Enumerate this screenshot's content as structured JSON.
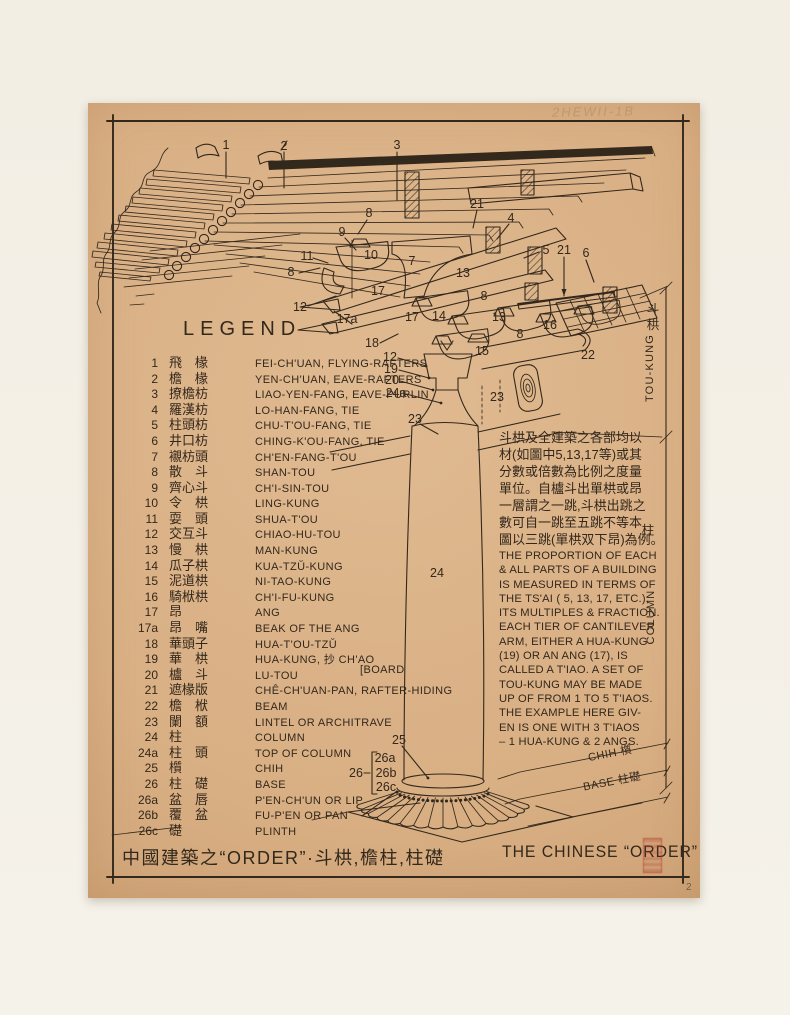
{
  "artwork": {
    "pencil_note": "2HEWII-1B",
    "page_mark": "2"
  },
  "legend": {
    "title": "LEGEND",
    "items": [
      {
        "num": "1",
        "cn": "飛　椽",
        "en": "FEI-CH'UAN, FLYING-RAFTERS"
      },
      {
        "num": "2",
        "cn": "檐　椽",
        "en": "YEN-CH'UAN, EAVE-RAFTERS"
      },
      {
        "num": "3",
        "cn": "撩檐枋",
        "en": "LIAO-YEN-FANG, EAVE-PURLIN"
      },
      {
        "num": "4",
        "cn": "羅漢枋",
        "en": "LO-HAN-FANG, TIE"
      },
      {
        "num": "5",
        "cn": "柱頭枋",
        "en": "CHU-T'OU-FANG, TIE"
      },
      {
        "num": "6",
        "cn": "井口枋",
        "en": "CHING-K'OU-FANG, TIE"
      },
      {
        "num": "7",
        "cn": "襯枋頭",
        "en": "CH'EN-FANG-T'OU"
      },
      {
        "num": "8",
        "cn": "散　斗",
        "en": "SHAN-TOU"
      },
      {
        "num": "9",
        "cn": "齊心斗",
        "en": "CH'I-SIN-TOU"
      },
      {
        "num": "10",
        "cn": "令　栱",
        "en": "LING-KUNG"
      },
      {
        "num": "11",
        "cn": "耍　頭",
        "en": "SHUA-T'OU"
      },
      {
        "num": "12",
        "cn": "交互斗",
        "en": "CHIAO-HU-TOU"
      },
      {
        "num": "13",
        "cn": "慢　栱",
        "en": "MAN-KUNG"
      },
      {
        "num": "14",
        "cn": "瓜子栱",
        "en": "KUA-TZŬ-KUNG"
      },
      {
        "num": "15",
        "cn": "泥道栱",
        "en": "NI-TAO-KUNG"
      },
      {
        "num": "16",
        "cn": "騎栿栱",
        "en": "CH'I-FU-KUNG"
      },
      {
        "num": "17",
        "cn": "昂",
        "en": "ANG"
      },
      {
        "num": "17a",
        "cn": "昂　嘴",
        "en": "BEAK OF THE ANG"
      },
      {
        "num": "18",
        "cn": "華頭子",
        "en": "HUA-T'OU-TZŬ"
      },
      {
        "num": "19",
        "cn": "華　栱",
        "en": "HUA-KUNG, 抄 CH'AO"
      },
      {
        "num": "20",
        "cn": "櫨　斗",
        "en": "LU-TOU",
        "note": "[BOARD"
      },
      {
        "num": "21",
        "cn": "遮椽版",
        "en": "CHÊ-CH'UAN-PAN, RAFTER-HIDING"
      },
      {
        "num": "22",
        "cn": "檐　栿",
        "en": "BEAM"
      },
      {
        "num": "23",
        "cn": "闌　額",
        "en": "LINTEL OR ARCHITRAVE"
      },
      {
        "num": "24",
        "cn": "柱",
        "en": "COLUMN"
      },
      {
        "num": "24a",
        "cn": "柱　頭",
        "en": "TOP OF COLUMN"
      },
      {
        "num": "25",
        "cn": "櫍",
        "en": "CHIH"
      },
      {
        "num": "26",
        "cn": "柱　礎",
        "en": "BASE"
      },
      {
        "num": "26a",
        "cn": "盆　唇",
        "en": "P'EN-CH'UN OR LIP"
      },
      {
        "num": "26b",
        "cn": "覆　盆",
        "en": "FU-P'EN OR PAN"
      },
      {
        "num": "26c",
        "cn": "礎",
        "en": "PLINTH"
      }
    ]
  },
  "notes": {
    "chinese_lines": [
      "斗栱及全建築之各部均以",
      "材(如圖中5,13,17等)或其",
      "分數或倍數為比例之度量",
      "單位。自櫨斗出單栱或昂",
      "一層謂之一跳,斗栱出跳之",
      "數可自一跳至五跳不等本",
      "圖以三跳(單栱双下昂)為例。"
    ],
    "english_lines": [
      "THE PROPORTION OF EACH",
      "& ALL PARTS OF A BUILDING",
      "IS MEASURED IN TERMS OF",
      "THE TS'AI ( 5, 13, 17, ETC.),",
      "ITS MULTIPLES & FRACTION.",
      "EACH TIER OF CANTILEVER",
      "ARM, EITHER A HUA-KUNG",
      "(19) OR AN ANG (17), IS",
      "CALLED A T'IAO.  A SET OF",
      "TOU-KUNG MAY BE MADE",
      "UP OF FROM 1 TO 5 T'IAOS.",
      "THE EXAMPLE HERE GIV-",
      "EN IS ONE WITH 3 T'IAOS",
      "– 1 HUA-KUNG & 2 ANGS."
    ]
  },
  "dimension_labels": {
    "toukung_cn": "斗栱",
    "toukung_en": "TOU-KUNG",
    "column_cn": "柱",
    "column_en": "COLUMN",
    "chih": "CHIH 櫍",
    "base": "BASE 柱礎"
  },
  "title_bar": {
    "chinese": "中國建築之“ORDER”·斗栱,檐柱,柱礎",
    "english": "THE CHINESE “ORDER”"
  },
  "diagram": {
    "callouts": [
      [
        "1",
        226,
        145
      ],
      [
        "2",
        284,
        146
      ],
      [
        "3",
        397,
        145
      ],
      [
        "21",
        477,
        204
      ],
      [
        "4",
        511,
        218
      ],
      [
        "8",
        369,
        213
      ],
      [
        "9",
        342,
        232
      ],
      [
        "11",
        307,
        256
      ],
      [
        "10",
        371,
        255
      ],
      [
        "7",
        412,
        261
      ],
      [
        "5",
        546,
        250
      ],
      [
        "21",
        564,
        250
      ],
      [
        "6",
        586,
        253
      ],
      [
        "8",
        291,
        272
      ],
      [
        "12",
        300,
        307
      ],
      [
        "17",
        378,
        291
      ],
      [
        "13",
        463,
        273
      ],
      [
        "8",
        484,
        296
      ],
      [
        "17",
        412,
        317
      ],
      [
        "14",
        439,
        316
      ],
      [
        "13",
        499,
        317
      ],
      [
        "16",
        550,
        325
      ],
      [
        "8",
        520,
        334
      ],
      [
        "17a",
        347,
        319
      ],
      [
        "18",
        372,
        343
      ],
      [
        "12",
        390,
        357
      ],
      [
        "19",
        391,
        369
      ],
      [
        "20",
        392,
        380
      ],
      [
        "24a",
        396,
        393
      ],
      [
        "15",
        482,
        351
      ],
      [
        "22",
        588,
        355
      ],
      [
        "23",
        497,
        397
      ],
      [
        "23",
        415,
        419
      ],
      [
        "24",
        437,
        573
      ],
      [
        "25",
        399,
        740
      ],
      [
        "26",
        356,
        773
      ],
      [
        "26a",
        385,
        758
      ],
      [
        "26b",
        386,
        773
      ],
      [
        "26c",
        386,
        787
      ]
    ]
  },
  "colors": {
    "paper": "#d9af84",
    "ink": "#33281c",
    "seal_red": "#b2342a",
    "matte": "#f2eee4"
  }
}
